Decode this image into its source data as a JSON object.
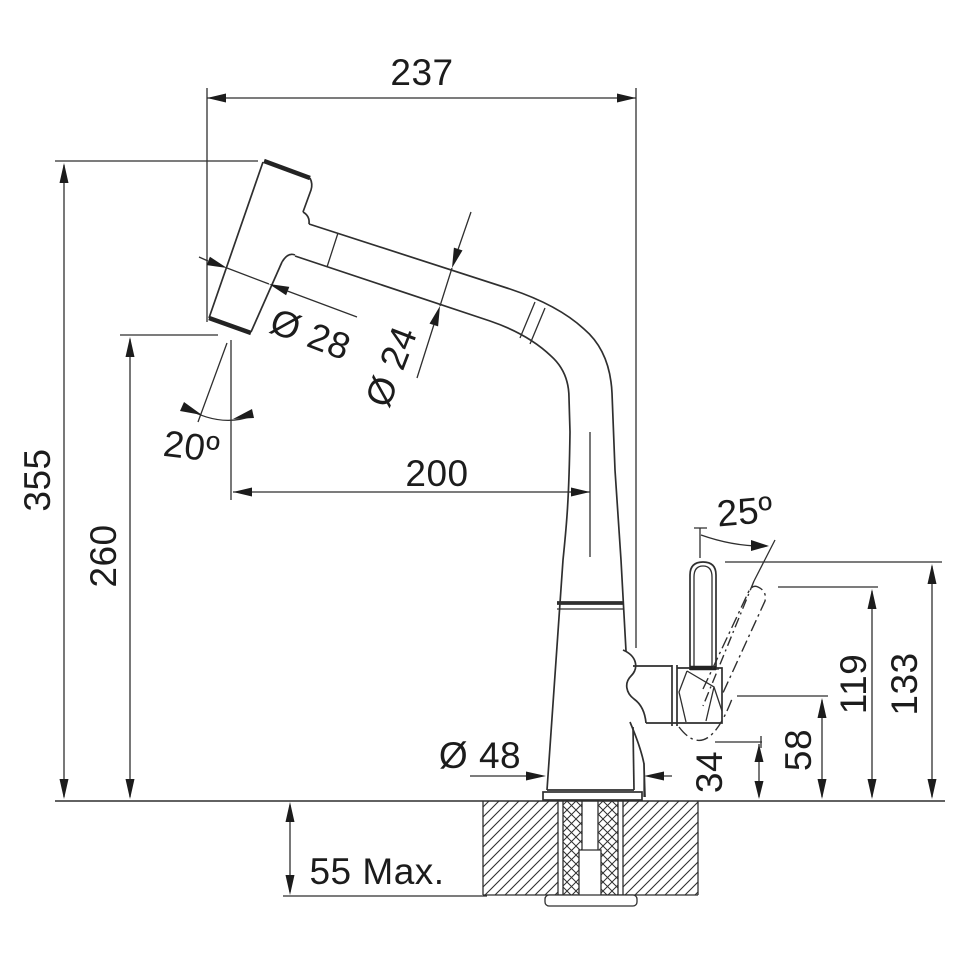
{
  "drawing": {
    "kind": "faucet-dimension-drawing",
    "subject": "pull-out spray kitchen tap, side elevation with installation dimensions",
    "colors": {
      "line": "#2f2f2f",
      "text": "#1c1c1c",
      "background": "#ffffff"
    }
  },
  "labels": {
    "reach_total": "237",
    "height_total": "355",
    "height_spray_tip": "260",
    "reach_to_center": "200",
    "dia_spray_head": "Ø 28",
    "dia_spout_tube": "Ø 24",
    "angle_spray_head": "20º",
    "angle_lever": "25º",
    "h_lever_tilted": "119",
    "h_lever_top": "133",
    "h_lever_bottom": "58",
    "h_lever_clearance": "34",
    "dia_base": "Ø 48",
    "counter_thickness": "55 Max."
  }
}
